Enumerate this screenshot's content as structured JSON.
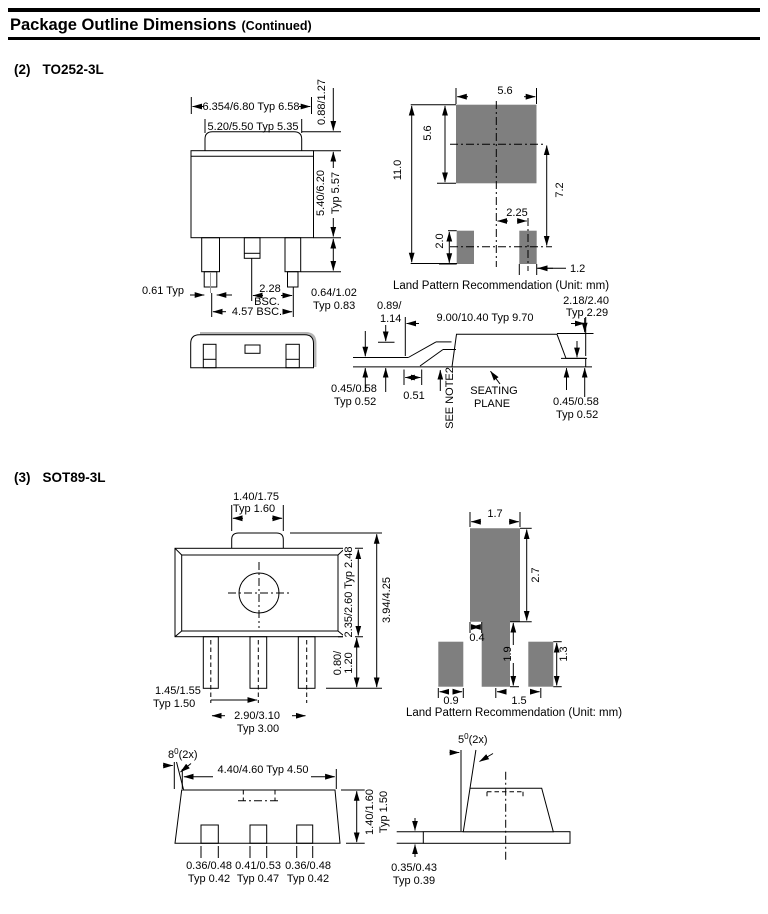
{
  "header": {
    "title": "Package Outline Dimensions",
    "suffix": "(Continued)"
  },
  "to252": {
    "num": "(2)",
    "name": "TO252-3L",
    "front": {
      "top_width": "6.354/6.80 Typ 6.58",
      "tab_width": "5.20/5.50 Typ 5.35",
      "tab_height": "0.88/1.27",
      "body_height1": "5.40/6.20",
      "body_height2": "Typ 5.57",
      "lead_tip": "0.61 Typ",
      "pitch1": "2.28",
      "pitch2": "BSC.",
      "span": "4.57 BSC.",
      "lead_w1": "0.64/1.02",
      "lead_w2": "Typ 0.83"
    },
    "land": {
      "pad_w": "5.6",
      "pad_h": "5.6",
      "total_h": "11.0",
      "pad_gap": "7.2",
      "pitch": "2.25",
      "small_h": "2.0",
      "small_w": "1.2",
      "caption": "Land Pattern Recommendation (Unit: mm)"
    },
    "side": {
      "standoff1": "0.89/",
      "standoff2": "1.14",
      "length": "9.00/10.40 Typ 9.70",
      "tab1": "2.18/2.40",
      "tab2": "Typ 2.29",
      "foot": "0.51",
      "note": "SEE NOTE2",
      "seat1": "SEATING",
      "seat2": "PLANE",
      "thkl1": "0.45/0.58",
      "thkl2": "Typ 0.52",
      "thkr1": "0.45/0.58",
      "thkr2": "Typ 0.52"
    }
  },
  "sot89": {
    "num": "(3)",
    "name": "SOT89-3L",
    "front": {
      "tab1": "1.40/1.75",
      "tab2": "Typ 1.60",
      "body_h": "2.35/2.60 Typ 2.48",
      "total_h": "3.94/4.25",
      "lead1": "0.80/",
      "lead2": "1.20",
      "pitch1": "1.45/1.55",
      "pitch2": "Typ 1.50",
      "span1": "2.90/3.10",
      "span2": "Typ 3.00"
    },
    "land": {
      "pad_w": "1.7",
      "pad_h": "2.7",
      "step": "0.4",
      "center_len": "1.9",
      "side_h": "1.3",
      "side_w": "0.9",
      "pitch": "1.5",
      "caption": "Land Pattern Recommendation (Unit: mm)"
    },
    "bottom": {
      "angle_base": "8",
      "angle_sup": "0",
      "angle_rest": "(2x)",
      "width": "4.40/4.60 Typ 4.50",
      "h1": "1.40/1.60",
      "h2": "Typ 1.50",
      "l1a": "0.36/0.48",
      "l1b": "Typ 0.42",
      "l2a": "0.41/0.53",
      "l2b": "Typ 0.47",
      "l3a": "0.36/0.48",
      "l3b": "Typ 0.42"
    },
    "side": {
      "angle_base": "5",
      "angle_sup": "0",
      "angle_rest": "(2x)",
      "thk1": "0.35/0.43",
      "thk2": "Typ 0.39"
    }
  }
}
